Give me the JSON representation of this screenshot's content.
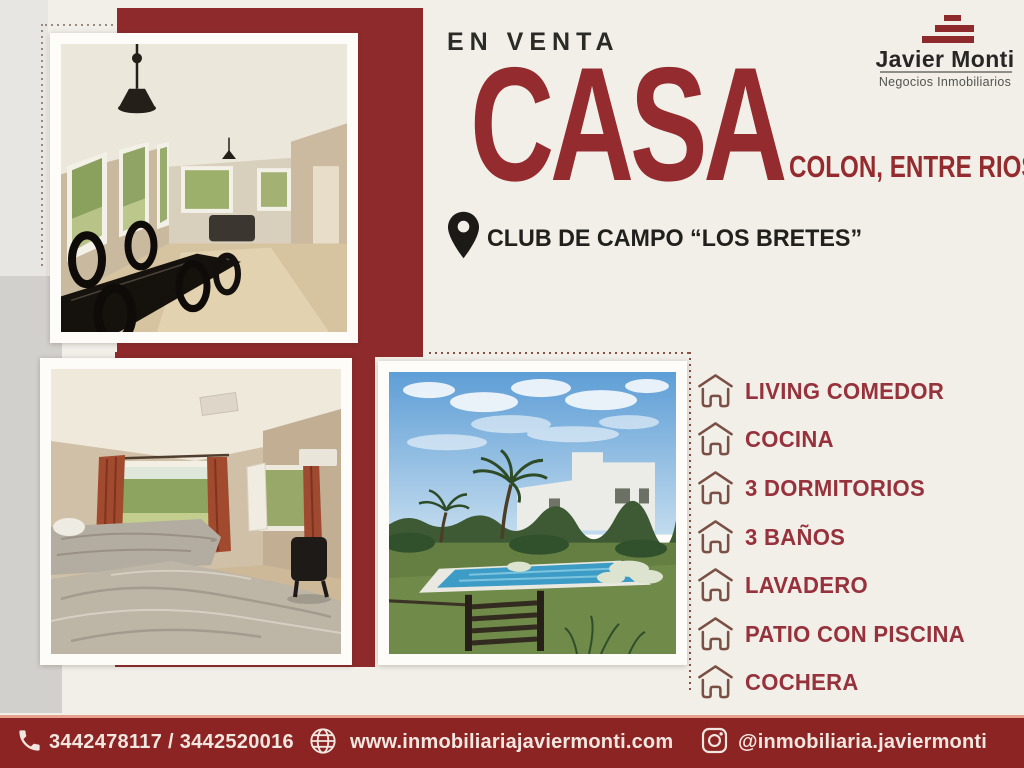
{
  "header": {
    "sale_label": "EN VENTA",
    "title": "CASA",
    "subtitle": "COLON, ENTRE RIOS"
  },
  "brand": {
    "name": "Javier Monti",
    "tagline": "Negocios Inmobiliarios"
  },
  "location": {
    "label": "CLUB DE CAMPO “LOS BRETES”"
  },
  "features": {
    "items": [
      {
        "label": "LIVING COMEDOR"
      },
      {
        "label": "COCINA"
      },
      {
        "label": "3 DORMITORIOS"
      },
      {
        "label": "3 BAÑOS"
      },
      {
        "label": "LAVADERO"
      },
      {
        "label": "PATIO CON PISCINA"
      },
      {
        "label": "COCHERA"
      }
    ]
  },
  "contact": {
    "phones": "3442478117 / 3442520016",
    "website": "www.inmobiliariajaviermonti.com",
    "instagram": "@inmobiliaria.javiermonti"
  },
  "icons": {
    "location": "map-pin-icon",
    "feature": "house-icon",
    "phone": "phone-icon",
    "website": "globe-icon",
    "instagram": "instagram-icon",
    "brand": "stairs-icon"
  },
  "colors": {
    "maroon": "#8E2A2B",
    "maroon_text": "#942B2E",
    "feature_text": "#97323C",
    "cream": "#F1EFE8",
    "gray_light": "#E8E6E2",
    "gray_dark": "#D2D0CC",
    "bar_bg": "#8B2423",
    "bar_border": "#E5A18E",
    "bar_text": "#F2E7E0",
    "dark_text": "#23211E"
  }
}
